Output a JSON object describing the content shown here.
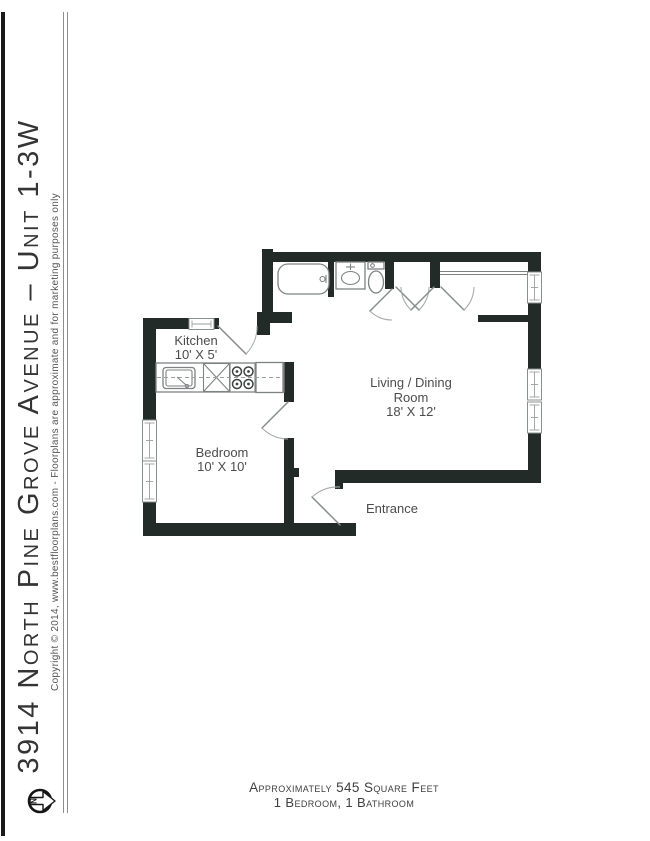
{
  "sidebar": {
    "title": "3914 North Pine Grove Avenue – Unit 1-3W",
    "copyright": "Copyright ©  2014, www.bestfloorplans.com - Floorplans are approximate and for marketing purposes only",
    "compass": {
      "label": "N"
    }
  },
  "floorplan": {
    "rooms": {
      "kitchen": {
        "label": "Kitchen",
        "dims": "10' X 5'"
      },
      "bedroom": {
        "label": "Bedroom",
        "dims": "10' X 10'"
      },
      "living": {
        "line1": "Living / Dining",
        "line2": "Room",
        "dims": "18' X 12'"
      },
      "entrance": {
        "label": "Entrance"
      }
    },
    "icons": [
      "bathtub-icon",
      "bathroom-sink-icon",
      "toilet-icon",
      "closet-rod-icon",
      "kitchen-sink-icon",
      "dishwasher-icon",
      "stove-icon",
      "refrigerator-icon",
      "window-symbol",
      "door-swing",
      "north-compass-icon"
    ]
  },
  "footer": {
    "line1": "Approximately 545 Square Feet",
    "line2": "1 Bedroom, 1 Bathroom"
  },
  "colors": {
    "wall": "#232b28",
    "fixture_outline": "#7d8382",
    "text_dark": "#3f3f3f",
    "text_label": "#4c4c4c"
  }
}
